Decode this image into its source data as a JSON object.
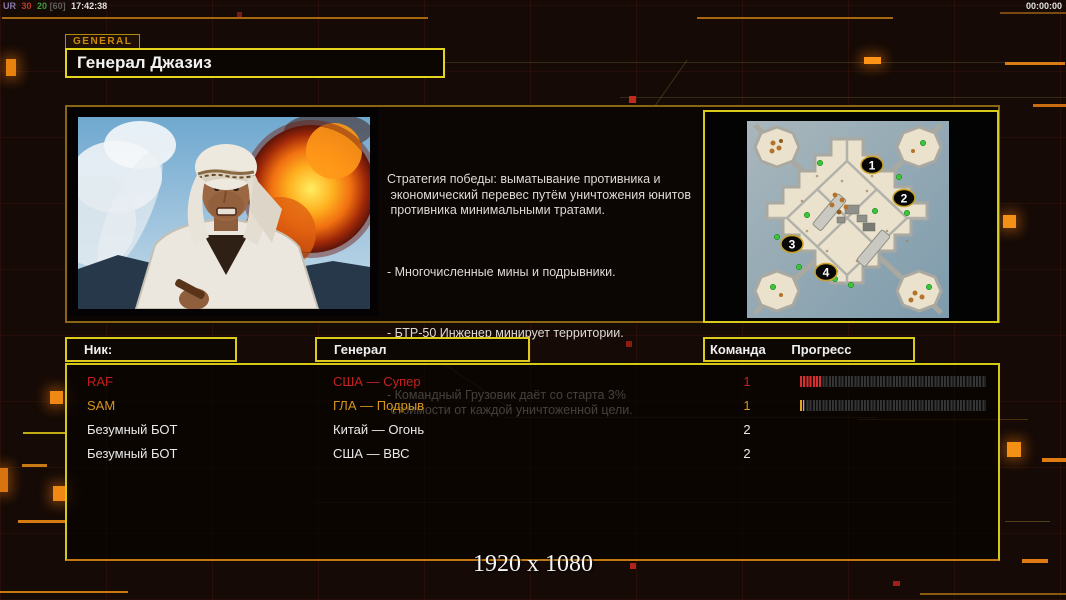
{
  "status_bar": {
    "seg1": "UR",
    "seg2": "30",
    "seg3": "20",
    "seg4": "[60]",
    "time": "17:42:38",
    "match_timer": "00:00:00"
  },
  "general_tab": "GENERAL",
  "general_title": "Генерал Джазиз",
  "strategy": {
    "intro": "Стратегия победы: выматывание противника и\n экономический перевес путём уничтожения юнитов\n противника минимальными тратами.",
    "bullets": [
      "- Многочисленные мины и подрывники.",
      "- БТР-50 Инженер минирует территории.",
      "- Командный Грузовик даёт со старта 3%\n стоимости от каждой уничтоженной цели."
    ]
  },
  "minimap": {
    "marker_labels": [
      "1",
      "2",
      "3",
      "4"
    ]
  },
  "players_table": {
    "headers": {
      "nick": "Ник:",
      "general": "Генерал",
      "team": "Команда",
      "progress": "Прогресс"
    },
    "rows": [
      {
        "nick": "RAF",
        "general": "США — Супер",
        "team": "1",
        "color": "#c42120",
        "progress_pct": 12,
        "bar_color": "#d83030"
      },
      {
        "nick": "SAM",
        "general": "ГЛА — Подрыв",
        "team": "1",
        "color": "#d5961c",
        "progress_pct": 2,
        "bar_color": "#e2aa1e"
      },
      {
        "nick": "Безумный БОТ",
        "general": "Китай — Огонь",
        "team": "2",
        "color": "#eaeaea",
        "progress_pct": null,
        "bar_color": null
      },
      {
        "nick": "Безумный БОТ",
        "general": "США — ВВС",
        "team": "2",
        "color": "#eaeaea",
        "progress_pct": null,
        "bar_color": null
      }
    ]
  },
  "footer": {
    "resolution": "1920 x 1080"
  },
  "colors": {
    "background": "#150a06",
    "border_yellow": "#d9c918",
    "border_gold": "#8a6614",
    "accent_orange": "#e8820f",
    "status_red": "#c42120",
    "status_gold": "#d5961c",
    "text_white": "#eaeaea"
  }
}
